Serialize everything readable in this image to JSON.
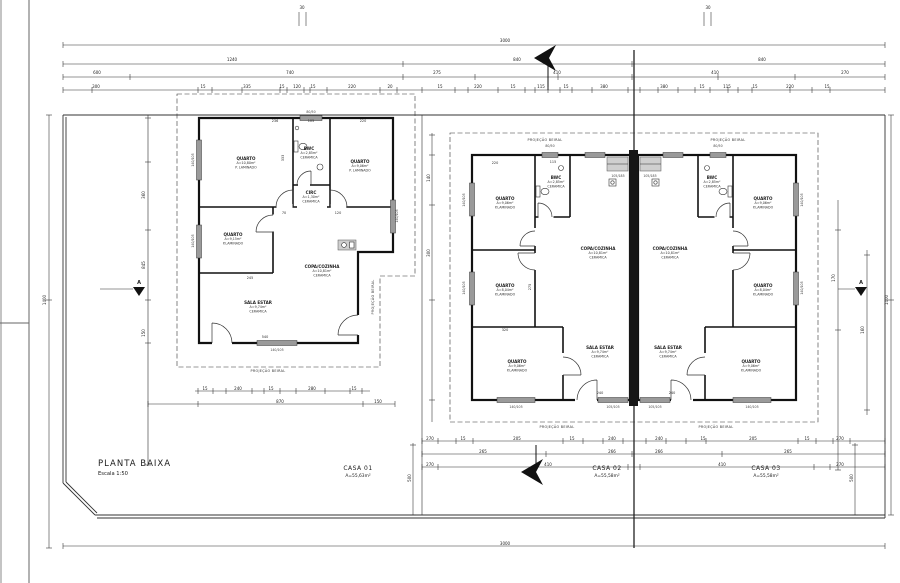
{
  "title_block": {
    "title": "PLANTA BAIXA",
    "scale": "Escala 1:50"
  },
  "houses": [
    {
      "name": "CASA 01",
      "area": "A=55,63m²"
    },
    {
      "name": "CASA 02",
      "area": "A=55,58m²"
    },
    {
      "name": "CASA 03",
      "area": "A=55,58m²"
    }
  ],
  "annotations": {
    "eave_label": "PROJEÇÃO BEIRAL",
    "section_letter": "A"
  },
  "rooms": [
    {
      "x": 246,
      "y": 160,
      "name": "QUARTO",
      "area": "A=10,80m²",
      "floor": "P. LAMINADO"
    },
    {
      "x": 309,
      "y": 150,
      "name": "BWC",
      "area": "A=2,85m²",
      "floor": "CERAMICA"
    },
    {
      "x": 360,
      "y": 163,
      "name": "QUARTO",
      "area": "A=9,06m²",
      "floor": "P. LAMINADO"
    },
    {
      "x": 311,
      "y": 194,
      "name": "CIRC",
      "area": "A=1,30m²",
      "floor": "CERAMICA"
    },
    {
      "x": 233,
      "y": 236,
      "name": "QUARTO",
      "area": "A=9,15m²",
      "floor": "P.LAMINADO"
    },
    {
      "x": 258,
      "y": 304,
      "name": "SALA ESTAR",
      "area": "A=9,74m²",
      "floor": "CERAMICA"
    },
    {
      "x": 322,
      "y": 268,
      "name": "COPA/COZINHA",
      "area": "A=10,81m²",
      "floor": "CERAMICA"
    },
    {
      "x": 505,
      "y": 200,
      "name": "QUARTO",
      "area": "A=9,06m²",
      "floor": "P.LAMINADO"
    },
    {
      "x": 556,
      "y": 179,
      "name": "BWC",
      "area": "A=2,85m²",
      "floor": "CERAMICA"
    },
    {
      "x": 598,
      "y": 250,
      "name": "COPA/COZINHA",
      "area": "A=10,81m²",
      "floor": "CERAMICA"
    },
    {
      "x": 505,
      "y": 287,
      "name": "QUARTO",
      "area": "A=8,04m²",
      "floor": "P.LAMINADO"
    },
    {
      "x": 517,
      "y": 363,
      "name": "QUARTO",
      "area": "A=9,06m²",
      "floor": "P.LAMINADO"
    },
    {
      "x": 600,
      "y": 349,
      "name": "SALA ESTAR",
      "area": "A=9,74m²",
      "floor": "CERAMICA"
    },
    {
      "x": 763,
      "y": 200,
      "name": "QUARTO",
      "area": "A=9,06m²",
      "floor": "P.LAMINADO"
    },
    {
      "x": 712,
      "y": 179,
      "name": "BWC",
      "area": "A=2,85m²",
      "floor": "CERAMICA"
    },
    {
      "x": 670,
      "y": 250,
      "name": "COPA/COZINHA",
      "area": "A=10,81m²",
      "floor": "CERAMICA"
    },
    {
      "x": 763,
      "y": 287,
      "name": "QUARTO",
      "area": "A=8,04m²",
      "floor": "P.LAMINADO"
    },
    {
      "x": 751,
      "y": 363,
      "name": "QUARTO",
      "area": "A=9,06m²",
      "floor": "P.LAMINADO"
    },
    {
      "x": 668,
      "y": 349,
      "name": "SALA ESTAR",
      "area": "A=9,74m²",
      "floor": "CERAMICA"
    }
  ],
  "dim_labels": [
    {
      "x": 505,
      "y": 42,
      "t": "3000"
    },
    {
      "x": 232,
      "y": 61,
      "t": "1240"
    },
    {
      "x": 517,
      "y": 61,
      "t": "840"
    },
    {
      "x": 762,
      "y": 61,
      "t": "840"
    },
    {
      "x": 97,
      "y": 74,
      "t": "600"
    },
    {
      "x": 290,
      "y": 74,
      "t": "740"
    },
    {
      "x": 437,
      "y": 74,
      "t": "275"
    },
    {
      "x": 557,
      "y": 74,
      "t": "410"
    },
    {
      "x": 715,
      "y": 74,
      "t": "410"
    },
    {
      "x": 845,
      "y": 74,
      "t": "270"
    },
    {
      "x": 96,
      "y": 88,
      "t": "300"
    },
    {
      "x": 203,
      "y": 88,
      "t": "15"
    },
    {
      "x": 247,
      "y": 88,
      "t": "335"
    },
    {
      "x": 282,
      "y": 88,
      "t": "15"
    },
    {
      "x": 297,
      "y": 88,
      "t": "120"
    },
    {
      "x": 313,
      "y": 88,
      "t": "15"
    },
    {
      "x": 352,
      "y": 88,
      "t": "220"
    },
    {
      "x": 390,
      "y": 88,
      "t": "20"
    },
    {
      "x": 440,
      "y": 88,
      "t": "15"
    },
    {
      "x": 478,
      "y": 88,
      "t": "220"
    },
    {
      "x": 513,
      "y": 88,
      "t": "15"
    },
    {
      "x": 541,
      "y": 88,
      "t": "115"
    },
    {
      "x": 566,
      "y": 88,
      "t": "15"
    },
    {
      "x": 604,
      "y": 88,
      "t": "380"
    },
    {
      "x": 664,
      "y": 88,
      "t": "380"
    },
    {
      "x": 702,
      "y": 88,
      "t": "15"
    },
    {
      "x": 727,
      "y": 88,
      "t": "115"
    },
    {
      "x": 755,
      "y": 88,
      "t": "15"
    },
    {
      "x": 790,
      "y": 88,
      "t": "220"
    },
    {
      "x": 827,
      "y": 88,
      "t": "15"
    },
    {
      "x": 302,
      "y": 9,
      "t": "30"
    },
    {
      "x": 708,
      "y": 9,
      "t": "30"
    },
    {
      "x": 430,
      "y": 440,
      "t": "270"
    },
    {
      "x": 463,
      "y": 440,
      "t": "15"
    },
    {
      "x": 517,
      "y": 440,
      "t": "205"
    },
    {
      "x": 572,
      "y": 440,
      "t": "15"
    },
    {
      "x": 612,
      "y": 440,
      "t": "240"
    },
    {
      "x": 659,
      "y": 440,
      "t": "240"
    },
    {
      "x": 703,
      "y": 440,
      "t": "15"
    },
    {
      "x": 753,
      "y": 440,
      "t": "205"
    },
    {
      "x": 807,
      "y": 440,
      "t": "15"
    },
    {
      "x": 840,
      "y": 440,
      "t": "270"
    },
    {
      "x": 483,
      "y": 453,
      "t": "265"
    },
    {
      "x": 612,
      "y": 453,
      "t": "266"
    },
    {
      "x": 659,
      "y": 453,
      "t": "266"
    },
    {
      "x": 788,
      "y": 453,
      "t": "265"
    },
    {
      "x": 430,
      "y": 466,
      "t": "270"
    },
    {
      "x": 548,
      "y": 466,
      "t": "410"
    },
    {
      "x": 722,
      "y": 466,
      "t": "410"
    },
    {
      "x": 840,
      "y": 466,
      "t": "270"
    },
    {
      "x": 505,
      "y": 545,
      "t": "3000"
    },
    {
      "x": 205,
      "y": 390,
      "t": "15"
    },
    {
      "x": 238,
      "y": 390,
      "t": "240"
    },
    {
      "x": 271,
      "y": 390,
      "t": "15"
    },
    {
      "x": 312,
      "y": 390,
      "t": "280"
    },
    {
      "x": 354,
      "y": 390,
      "t": "15"
    },
    {
      "x": 280,
      "y": 403,
      "t": "870"
    },
    {
      "x": 378,
      "y": 403,
      "t": "150"
    },
    {
      "x": 46,
      "y": 300,
      "t": "1400",
      "r": -90
    },
    {
      "x": 145,
      "y": 195,
      "t": "360",
      "r": -90
    },
    {
      "x": 145,
      "y": 265,
      "t": "845",
      "r": -90
    },
    {
      "x": 145,
      "y": 333,
      "t": "150",
      "r": -90
    },
    {
      "x": 430,
      "y": 178,
      "t": "140",
      "r": -90
    },
    {
      "x": 430,
      "y": 253,
      "t": "300",
      "r": -90
    },
    {
      "x": 835,
      "y": 278,
      "t": "170",
      "r": -90
    },
    {
      "x": 864,
      "y": 330,
      "t": "160",
      "r": -90
    },
    {
      "x": 411,
      "y": 478,
      "t": "500",
      "r": -90
    },
    {
      "x": 853,
      "y": 478,
      "t": "500",
      "r": -90
    },
    {
      "x": 888,
      "y": 300,
      "t": "1400",
      "r": -90
    },
    {
      "x": 275,
      "y": 122,
      "t": "236",
      "s": 1
    },
    {
      "x": 311,
      "y": 122,
      "t": "105",
      "s": 1
    },
    {
      "x": 363,
      "y": 122,
      "t": "220",
      "s": 1
    },
    {
      "x": 284,
      "y": 158,
      "t": "333",
      "r": -90,
      "s": 1
    },
    {
      "x": 250,
      "y": 279,
      "t": "245",
      "s": 1
    },
    {
      "x": 265,
      "y": 338,
      "t": "540",
      "s": 1
    },
    {
      "x": 284,
      "y": 214,
      "t": "70",
      "s": 1
    },
    {
      "x": 338,
      "y": 214,
      "t": "120",
      "s": 1
    },
    {
      "x": 495,
      "y": 164,
      "t": "220",
      "s": 1
    },
    {
      "x": 553,
      "y": 163,
      "t": "115",
      "s": 1
    },
    {
      "x": 531,
      "y": 287,
      "t": "275",
      "r": -90,
      "s": 1
    },
    {
      "x": 505,
      "y": 331,
      "t": "320",
      "s": 1
    },
    {
      "x": 600,
      "y": 394,
      "t": "240",
      "s": 1
    },
    {
      "x": 672,
      "y": 394,
      "t": "240",
      "s": 1
    }
  ],
  "window_tags": [
    {
      "x": 194,
      "y": 160,
      "t": "140/105",
      "r": -90
    },
    {
      "x": 194,
      "y": 241,
      "t": "140/105",
      "r": -90
    },
    {
      "x": 398,
      "y": 216,
      "t": "140/105",
      "r": -90
    },
    {
      "x": 311,
      "y": 113,
      "t": "80/50"
    },
    {
      "x": 277,
      "y": 351,
      "t": "140/105"
    },
    {
      "x": 465,
      "y": 200,
      "t": "140/105",
      "r": -90
    },
    {
      "x": 465,
      "y": 288,
      "t": "140/105",
      "r": -90
    },
    {
      "x": 516,
      "y": 408,
      "t": "140/105"
    },
    {
      "x": 613,
      "y": 408,
      "t": "105/105"
    },
    {
      "x": 550,
      "y": 147,
      "t": "80/50"
    },
    {
      "x": 618,
      "y": 177,
      "t": "105/185"
    },
    {
      "x": 803,
      "y": 200,
      "t": "140/105",
      "r": -90
    },
    {
      "x": 803,
      "y": 288,
      "t": "140/105",
      "r": -90
    },
    {
      "x": 752,
      "y": 408,
      "t": "140/105"
    },
    {
      "x": 655,
      "y": 408,
      "t": "105/105"
    },
    {
      "x": 718,
      "y": 147,
      "t": "80/50"
    },
    {
      "x": 650,
      "y": 177,
      "t": "105/185"
    }
  ],
  "tick_rows": [
    {
      "y": 45,
      "xs": [
        63,
        885
      ]
    },
    {
      "y": 64,
      "xs": [
        63,
        403,
        632,
        885
      ]
    },
    {
      "y": 77,
      "xs": [
        63,
        130,
        403,
        475,
        558,
        632,
        718,
        795,
        885
      ]
    },
    {
      "y": 90,
      "xs": [
        63,
        92,
        198,
        212,
        242,
        280,
        287,
        304,
        310,
        327,
        380,
        397,
        422,
        455,
        468,
        498,
        525,
        535,
        548,
        560,
        572,
        592,
        628,
        640,
        658,
        678,
        695,
        710,
        728,
        738,
        752,
        790,
        812,
        830,
        885
      ]
    },
    {
      "y": 391,
      "xs": [
        198,
        213,
        226,
        252,
        264,
        280,
        296,
        325,
        350,
        362
      ]
    },
    {
      "y": 404,
      "xs": [
        148,
        198,
        363,
        395
      ]
    },
    {
      "y": 441,
      "xs": [
        422,
        438,
        456,
        473,
        563,
        583,
        603,
        623,
        646,
        666,
        686,
        706,
        798,
        816,
        833,
        850,
        885
      ]
    },
    {
      "y": 454,
      "xs": [
        422,
        546,
        632,
        722,
        885
      ]
    },
    {
      "y": 467,
      "xs": [
        422,
        438,
        628,
        640,
        814,
        830,
        885
      ]
    },
    {
      "y": 546,
      "xs": [
        63,
        885
      ]
    }
  ],
  "tick_cols": [
    {
      "x": 49,
      "ys": [
        115,
        300,
        548
      ]
    },
    {
      "x": 148,
      "ys": [
        118,
        162,
        230,
        300,
        343,
        465
      ]
    },
    {
      "x": 432,
      "ys": [
        135,
        155,
        205,
        300,
        400
      ]
    },
    {
      "x": 838,
      "ys": [
        230,
        330,
        470
      ]
    },
    {
      "x": 867,
      "ys": [
        255,
        410
      ]
    },
    {
      "x": 413,
      "ys": [
        445,
        515
      ]
    },
    {
      "x": 855,
      "ys": [
        445,
        515
      ]
    },
    {
      "x": 891,
      "ys": [
        115,
        300,
        515
      ]
    }
  ]
}
